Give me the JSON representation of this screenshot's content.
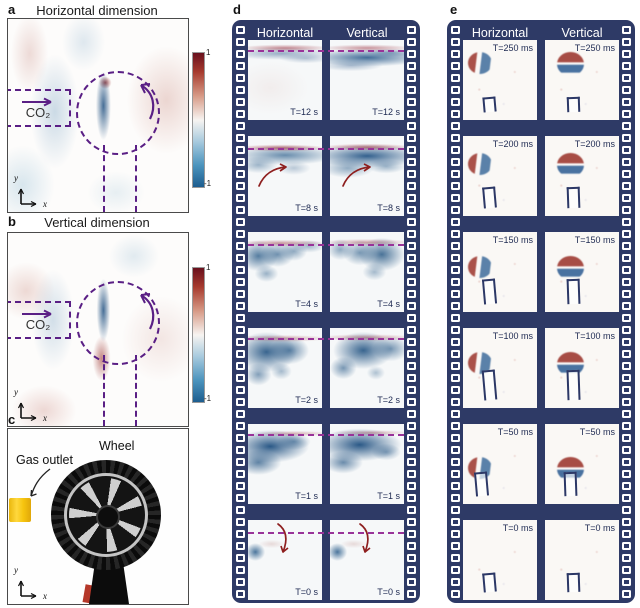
{
  "figure": {
    "panels": {
      "a": {
        "label": "a",
        "title": "Horizontal dimension",
        "gas_label": "CO₂",
        "colorbar": {
          "max": "1",
          "min": "-1"
        },
        "axis": {
          "x": "x",
          "y": "y"
        }
      },
      "b": {
        "label": "b",
        "title": "Vertical dimension",
        "gas_label": "CO₂",
        "colorbar": {
          "max": "1",
          "min": "-1"
        },
        "axis": {
          "x": "x",
          "y": "y"
        }
      },
      "c": {
        "label": "c",
        "wheel_label": "Wheel",
        "gas_outlet_label": "Gas outlet",
        "axis": {
          "x": "x",
          "y": "y"
        }
      },
      "d": {
        "label": "d",
        "columns": [
          "Horizontal",
          "Vertical"
        ],
        "times": [
          "T=12 s",
          "T=8 s",
          "T=4 s",
          "T=2 s",
          "T=1 s",
          "T=0 s"
        ]
      },
      "e": {
        "label": "e",
        "columns": [
          "Horizontal",
          "Vertical"
        ],
        "times": [
          "T=250 ms",
          "T=200 ms",
          "T=150 ms",
          "T=100 ms",
          "T=50 ms",
          "T=0 ms"
        ]
      }
    },
    "colors": {
      "film_navy": "#2e3a66",
      "dash_purple": "#5a1f85",
      "dash_magenta": "#993399",
      "arrow_red": "#8e1f1f",
      "colorbar_top_red": "#69101d",
      "colorbar_bottom_blue": "#1d5d8f",
      "gas_outlet_yellow": "#f6c40e"
    }
  }
}
